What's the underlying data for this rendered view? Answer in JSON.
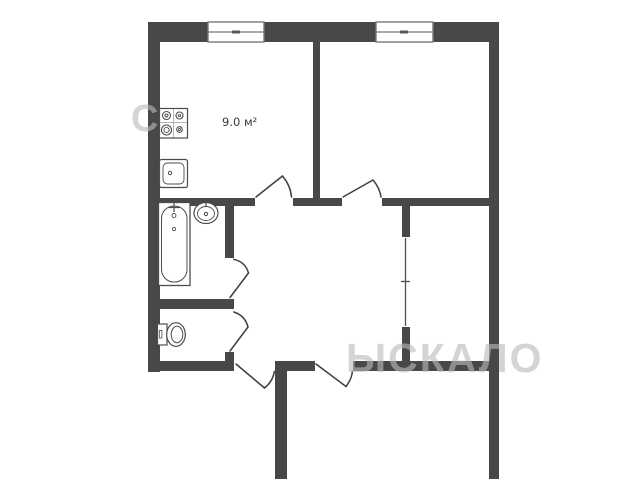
{
  "labels": {
    "kitchen_area": "9.0 м²"
  },
  "watermark": {
    "top_fragment": "С",
    "bottom_fragment": "ЫСКАЛО",
    "color": "#bababa"
  },
  "colors": {
    "wall": "#484848",
    "background": "#ffffff",
    "fixture_outline": "#4c4c4c",
    "window_frame": "#787878"
  },
  "fixtures": [
    "stove",
    "kitchen-sink",
    "bathtub",
    "washbasin",
    "toilet"
  ]
}
